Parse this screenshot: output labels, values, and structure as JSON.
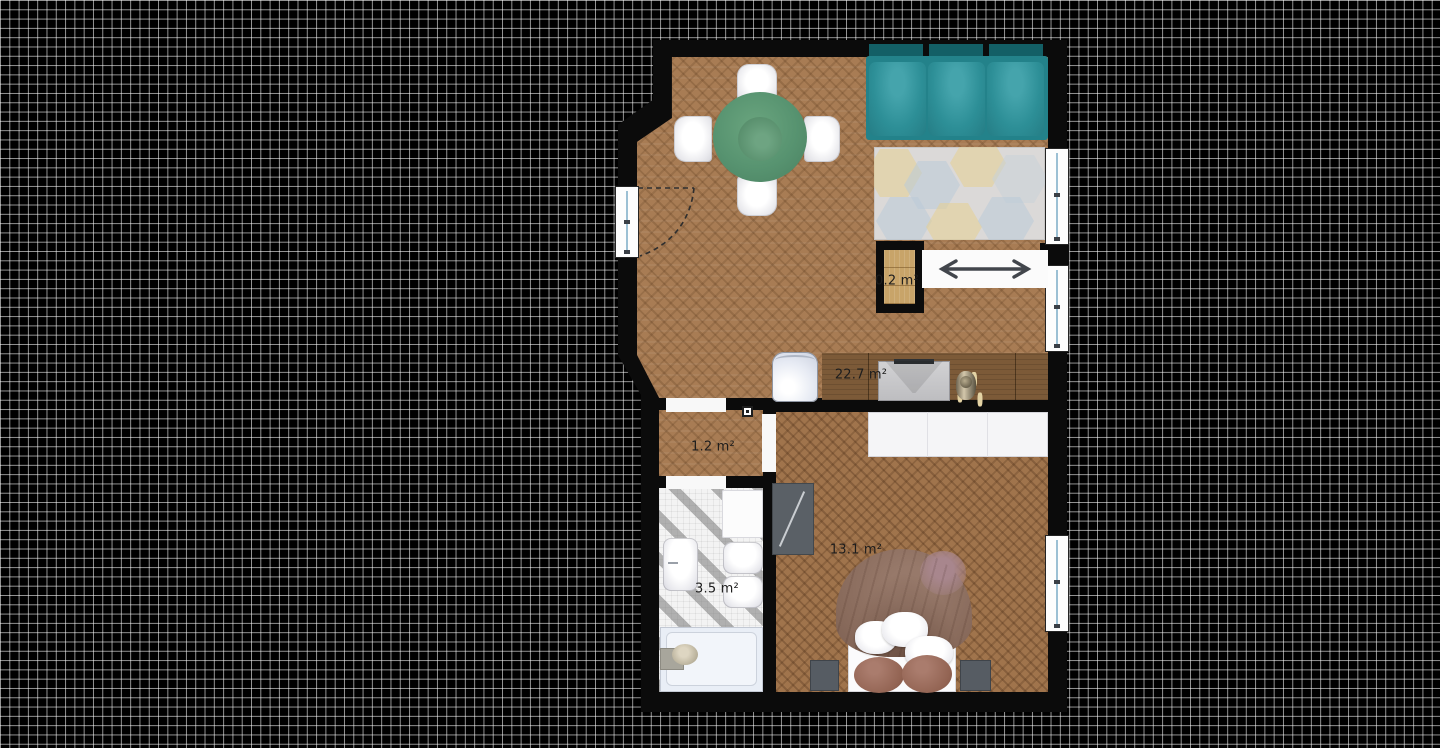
{
  "plan": {
    "rooms": [
      {
        "name": "living-room",
        "area_label": "22.7 m²"
      },
      {
        "name": "hallway",
        "area_label": "1.2 m²"
      },
      {
        "name": "bathroom",
        "area_label": "3.5 m²"
      },
      {
        "name": "bedroom",
        "area_label": "13.1 m²"
      },
      {
        "name": "closet",
        "area_label": "0.2 m²"
      }
    ],
    "colors": {
      "background": "#000000",
      "grid_line": "#949494",
      "wall": "#0b0b0b",
      "wood_floor": "#a87c54",
      "bathroom_tile": "#c9c9c9",
      "sofa_teal": "#2a8b93",
      "table_green": "#579370",
      "rug_base": "#dbd9d8",
      "bed_duvet": "#886a5b",
      "window_glass": "#9cc0d4"
    },
    "icons": [
      "coat-rack-icon",
      "door-swing-arc-icon",
      "outlet-icon"
    ]
  }
}
